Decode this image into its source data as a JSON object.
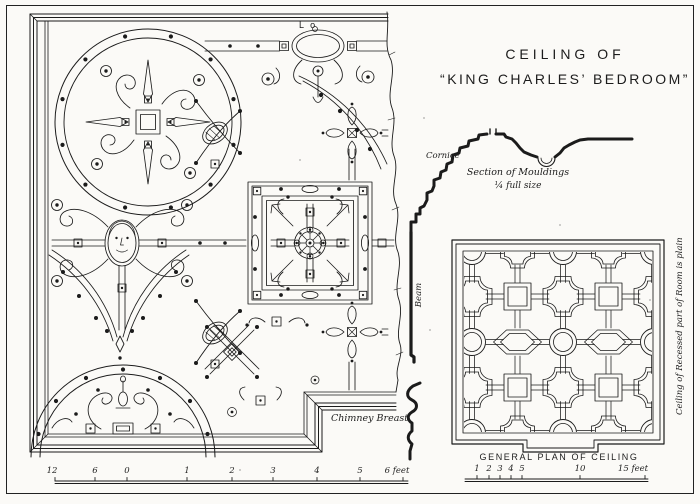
{
  "plate": {
    "title": {
      "line1": "CEILING OF",
      "line2": "“KING CHARLES’ BEDROOM”"
    },
    "section": {
      "cornice_label": "Cornice",
      "caption_line1": "Section of Mouldings",
      "caption_line2": "¼ full size",
      "beam_label": "Beam"
    },
    "main_plan": {
      "chimney_label": "Chimney Breast",
      "ref_letter": "L o"
    },
    "general_plan": {
      "caption": "GENERAL PLAN OF CEILING",
      "side_note": "Ceiling of Recessed part of Room is plain"
    },
    "scales": {
      "left_ticks": [
        "12",
        "6",
        "0",
        "1",
        "2",
        "3",
        "4",
        "5",
        "6 feet"
      ],
      "right_ticks": [
        "1",
        "2",
        "3",
        "4",
        "5",
        "10",
        "15 feet"
      ]
    },
    "colors": {
      "ink": "#1b1b1b",
      "paper": "#fbfaf7"
    }
  }
}
